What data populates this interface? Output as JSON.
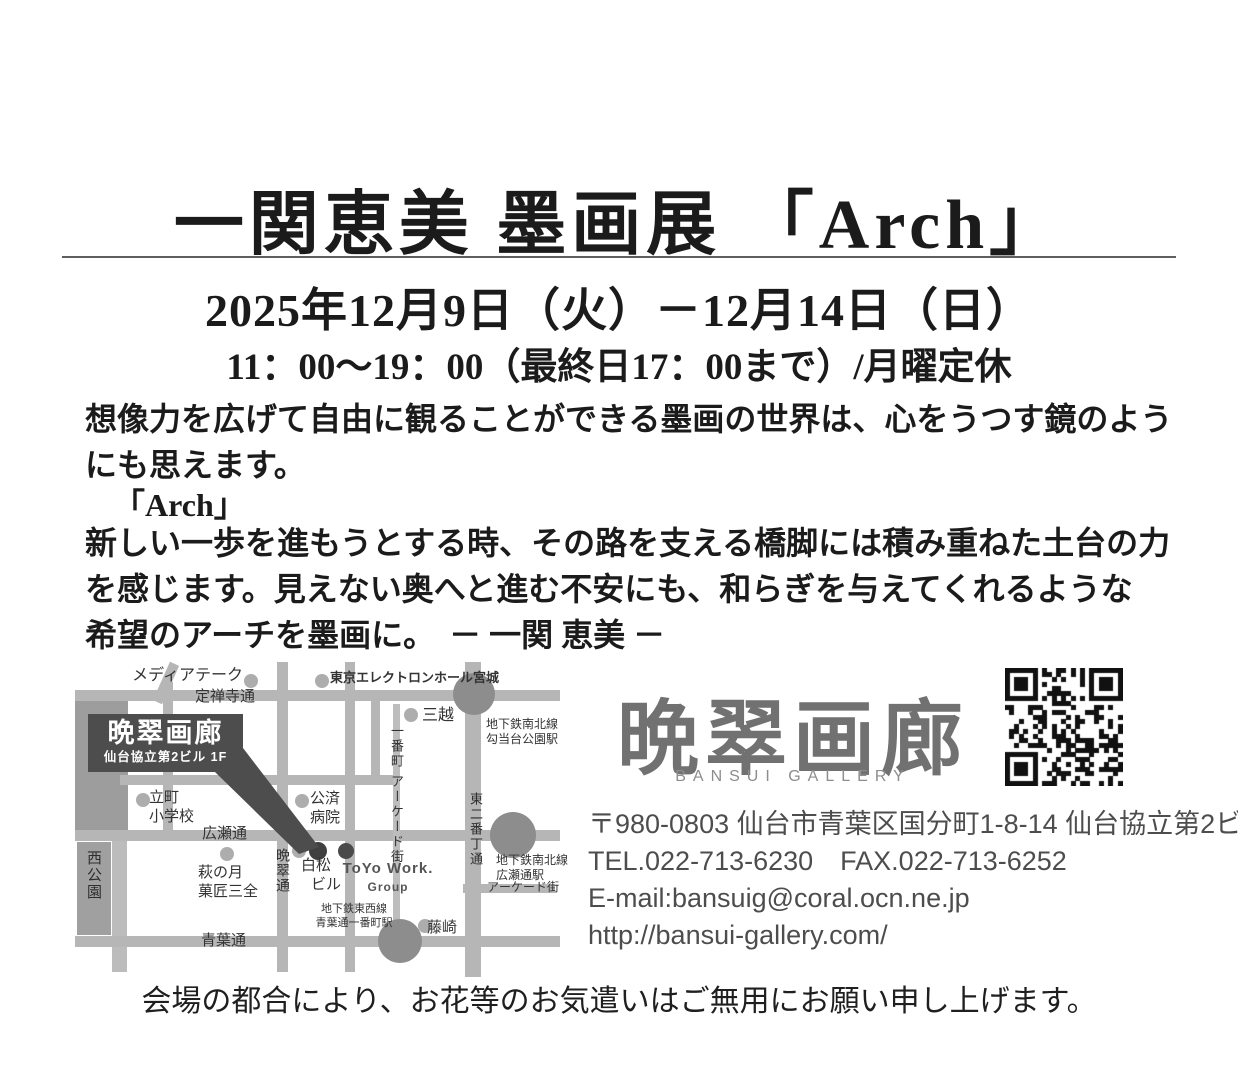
{
  "header": {
    "title": "一関恵美 墨画展 「Arch」",
    "date_line": "2025年12月9日（火）－12月14日（日）",
    "time_line": "11：00～19：00（最終日17：00まで）/月曜定休"
  },
  "body": {
    "p1_lines": [
      "想像力を広げて自由に観ることができる墨画の世界は、心をうつす鏡のよう",
      "にも思えます。"
    ],
    "quote": "「Arch」",
    "p2_lines": [
      "新しい一歩を進もうとする時、その路を支える橋脚には積み重ねた土台の力",
      "を感じます。見えない奥へと進む不安にも、和らぎを与えてくれるような",
      "希望のアーチを墨画に。"
    ],
    "signature": "－ 一関 恵美 －"
  },
  "map": {
    "callout": {
      "title": "晩翠画廊",
      "subtitle": "仙台協立第2ビル 1F"
    },
    "streets": {
      "jozenji": "定禅寺通",
      "hirose": "広瀬通",
      "aoba": "青葉通",
      "bansui_dori": "晩翠通",
      "ichibancho_arcade": "一番町 アーケード街",
      "higashi_nibancho": "東二番丁通",
      "arcade_right": "アーケード街"
    },
    "places": {
      "mediatheque": "メディアテーク",
      "tokyo_electron_hall": "東京エレクトロンホール宮城",
      "mitsukoshi": "三越",
      "tachimachi_l1": "立町",
      "tachimachi_l2": "小学校",
      "kosai_l1": "公済",
      "kosai_l2": "病院",
      "haginotsuki_l1": "萩の月",
      "haginotsuki_l2": "菓匠三全",
      "shiramatsu_l1": "白松",
      "shiramatsu_l2": "ビル",
      "toyo_work_l1": "ToYo Work.",
      "toyo_work_l2": "Group",
      "fujisaki": "藤崎",
      "nishi_koen": "西公園"
    },
    "stations": {
      "kotodai_l1": "地下鉄南北線",
      "kotodai_l2": "勾当台公園駅",
      "hirosedori_l1": "地下鉄南北線",
      "hirosedori_l2": "広瀬通駅",
      "aobadori_l1": "地下鉄東西線",
      "aobadori_l2": "青葉通一番町駅"
    }
  },
  "gallery": {
    "logo": "晩翠画廊",
    "logo_sub": "BANSUI GALLERY",
    "postal_address": "〒980-0803  仙台市青葉区国分町1-8-14 仙台協立第2ビル1F",
    "tel_fax": "TEL.022-713-6230　FAX.022-713-6252",
    "email": "E-mail:bansuig@coral.ocn.ne.jp",
    "url": "http://bansui-gallery.com/"
  },
  "footer": {
    "note": "会場の都合により、お花等のお気遣いはご無用にお願い申し上げます。"
  },
  "colors": {
    "street_gray": "#b6b6b6",
    "station_gray": "#8d8d8d",
    "callout_bg": "#4d4d4d",
    "logo_gray": "#717171",
    "text_black": "#1b1b1b",
    "qr_black": "#111111"
  }
}
